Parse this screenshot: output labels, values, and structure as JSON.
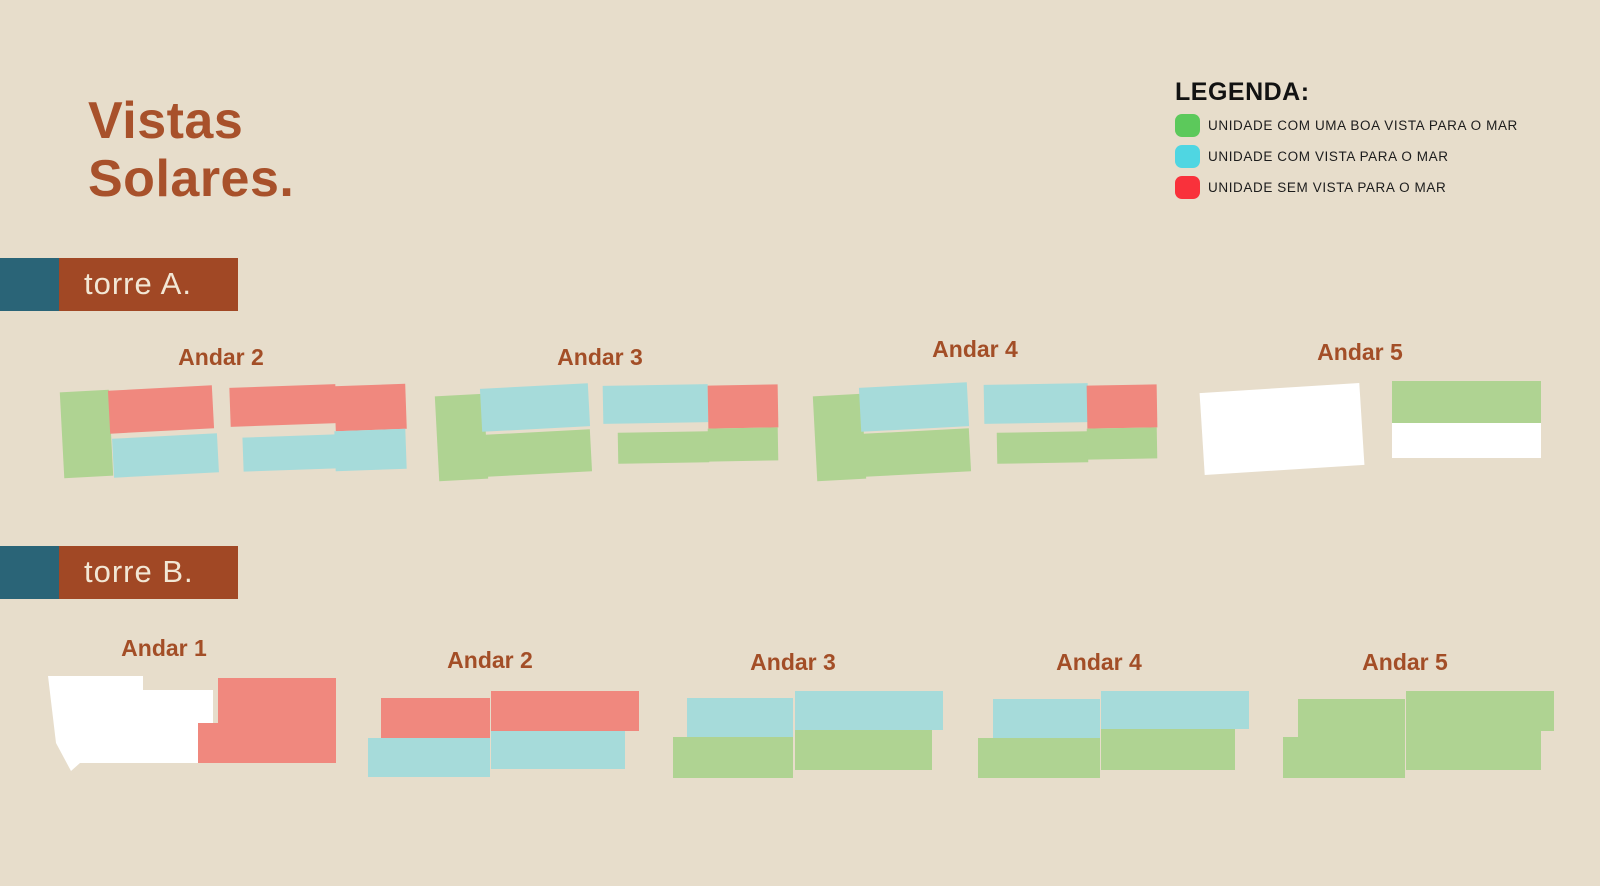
{
  "title": "Vistas Solares.",
  "colors": {
    "background": "#E7DDCB",
    "title_brown": "#A8512B",
    "label_brown": "#A34E27",
    "bar_brown": "#A14825",
    "bar_teal": "#2A6477",
    "bar_text": "#F2E7D5",
    "unit_good": "#AFD392",
    "unit_ok": "#A6DBDA",
    "unit_none": "#F0887E",
    "unit_empty": "#FFFFFF"
  },
  "legend": {
    "title": "LEGENDA:",
    "items": [
      {
        "label": "UNIDADE COM UMA BOA VISTA PARA O MAR",
        "swatch": "#5CC95B",
        "type": "good"
      },
      {
        "label": "UNIDADE COM VISTA PARA O MAR",
        "swatch": "#4FD6E2",
        "type": "ok"
      },
      {
        "label": "UNIDADE SEM VISTA PARA O MAR",
        "swatch": "#F9313B",
        "type": "none"
      }
    ]
  },
  "towers": [
    {
      "label": "torre A.",
      "bar": {
        "y": 258,
        "teal_w": 59,
        "brown_w": 179
      },
      "floors": [
        {
          "label": "Andar 2",
          "label_cx": 221,
          "label_top": 344,
          "units": [
            {
              "x": 62,
              "y": 391,
              "w": 49,
              "h": 86,
              "type": "good",
              "rot": -3
            },
            {
              "x": 109,
              "y": 388,
              "w": 104,
              "h": 43,
              "type": "none",
              "rot": -3
            },
            {
              "x": 113,
              "y": 436,
              "w": 105,
              "h": 39,
              "type": "ok",
              "rot": -3
            },
            {
              "x": 230,
              "y": 386,
              "w": 106,
              "h": 39,
              "type": "none",
              "rot": -2
            },
            {
              "x": 335,
              "y": 385,
              "w": 71,
              "h": 45,
              "type": "none",
              "rot": -2
            },
            {
              "x": 243,
              "y": 436,
              "w": 93,
              "h": 34,
              "type": "ok",
              "rot": -2
            },
            {
              "x": 335,
              "y": 430,
              "w": 71,
              "h": 40,
              "type": "ok",
              "rot": -2
            }
          ]
        },
        {
          "label": "Andar 3",
          "label_cx": 600,
          "label_top": 344,
          "units": [
            {
              "x": 437,
              "y": 395,
              "w": 49,
              "h": 85,
              "type": "good",
              "rot": -3
            },
            {
              "x": 481,
              "y": 386,
              "w": 108,
              "h": 43,
              "type": "ok",
              "rot": -3
            },
            {
              "x": 486,
              "y": 432,
              "w": 105,
              "h": 42,
              "type": "good",
              "rot": -3
            },
            {
              "x": 603,
              "y": 385,
              "w": 105,
              "h": 38,
              "type": "ok",
              "rot": -1
            },
            {
              "x": 708,
              "y": 385,
              "w": 70,
              "h": 43,
              "type": "none",
              "rot": -1
            },
            {
              "x": 618,
              "y": 432,
              "w": 91,
              "h": 31,
              "type": "good",
              "rot": -1
            },
            {
              "x": 708,
              "y": 428,
              "w": 70,
              "h": 33,
              "type": "good",
              "rot": -1
            }
          ]
        },
        {
          "label": "Andar 4",
          "label_cx": 975,
          "label_top": 336,
          "units": [
            {
              "x": 815,
              "y": 395,
              "w": 49,
              "h": 85,
              "type": "good",
              "rot": -3
            },
            {
              "x": 860,
              "y": 385,
              "w": 108,
              "h": 44,
              "type": "ok",
              "rot": -3
            },
            {
              "x": 864,
              "y": 431,
              "w": 106,
              "h": 43,
              "type": "good",
              "rot": -3
            },
            {
              "x": 984,
              "y": 384,
              "w": 104,
              "h": 39,
              "type": "ok",
              "rot": -1
            },
            {
              "x": 1087,
              "y": 385,
              "w": 70,
              "h": 43,
              "type": "none",
              "rot": -1
            },
            {
              "x": 997,
              "y": 432,
              "w": 91,
              "h": 31,
              "type": "good",
              "rot": -1
            },
            {
              "x": 1087,
              "y": 428,
              "w": 70,
              "h": 31,
              "type": "good",
              "rot": -1
            }
          ]
        },
        {
          "label": "Andar 5",
          "label_cx": 1360,
          "label_top": 339,
          "units": [
            {
              "x": 1202,
              "y": 388,
              "w": 160,
              "h": 82,
              "type": "empty",
              "rot": -3.6
            },
            {
              "x": 1392,
              "y": 381,
              "w": 149,
              "h": 42,
              "type": "good"
            },
            {
              "x": 1392,
              "y": 423,
              "w": 149,
              "h": 35,
              "type": "empty"
            }
          ]
        }
      ]
    },
    {
      "label": "torre B.",
      "bar": {
        "y": 546,
        "teal_w": 59,
        "brown_w": 179
      },
      "floors": [
        {
          "label": "Andar 1",
          "label_cx": 164,
          "label_top": 635,
          "units": [
            {
              "x": 48,
              "y": 676,
              "w": 165,
              "h": 95,
              "type": "empty",
              "poly": "0,0 95,0 95,14 165,14 165,87 32,87 23,95 8,67"
            },
            {
              "x": 198,
              "y": 723,
              "w": 20,
              "h": 40,
              "type": "none"
            },
            {
              "x": 218,
              "y": 678,
              "w": 118,
              "h": 85,
              "type": "none"
            }
          ]
        },
        {
          "label": "Andar 2",
          "label_cx": 490,
          "label_top": 647,
          "units": [
            {
              "x": 381,
              "y": 698,
              "w": 109,
              "h": 40,
              "type": "none"
            },
            {
              "x": 491,
              "y": 691,
              "w": 148,
              "h": 40,
              "type": "none"
            },
            {
              "x": 368,
              "y": 738,
              "w": 122,
              "h": 39,
              "type": "ok"
            },
            {
              "x": 491,
              "y": 731,
              "w": 134,
              "h": 38,
              "type": "ok"
            }
          ]
        },
        {
          "label": "Andar 3",
          "label_cx": 793,
          "label_top": 649,
          "units": [
            {
              "x": 687,
              "y": 698,
              "w": 106,
              "h": 39,
              "type": "ok"
            },
            {
              "x": 795,
              "y": 691,
              "w": 148,
              "h": 39,
              "type": "ok"
            },
            {
              "x": 673,
              "y": 737,
              "w": 120,
              "h": 41,
              "type": "good"
            },
            {
              "x": 795,
              "y": 730,
              "w": 137,
              "h": 40,
              "type": "good"
            }
          ]
        },
        {
          "label": "Andar 4",
          "label_cx": 1099,
          "label_top": 649,
          "units": [
            {
              "x": 993,
              "y": 699,
              "w": 107,
              "h": 39,
              "type": "ok"
            },
            {
              "x": 1101,
              "y": 691,
              "w": 148,
              "h": 38,
              "type": "ok"
            },
            {
              "x": 978,
              "y": 738,
              "w": 122,
              "h": 40,
              "type": "good"
            },
            {
              "x": 1101,
              "y": 729,
              "w": 134,
              "h": 41,
              "type": "good"
            }
          ]
        },
        {
          "label": "Andar 5",
          "label_cx": 1405,
          "label_top": 649,
          "units": [
            {
              "x": 1298,
              "y": 699,
              "w": 107,
              "h": 38,
              "type": "good"
            },
            {
              "x": 1406,
              "y": 691,
              "w": 148,
              "h": 40,
              "type": "good"
            },
            {
              "x": 1283,
              "y": 737,
              "w": 122,
              "h": 41,
              "type": "good"
            },
            {
              "x": 1406,
              "y": 731,
              "w": 135,
              "h": 39,
              "type": "good"
            }
          ]
        }
      ]
    }
  ]
}
